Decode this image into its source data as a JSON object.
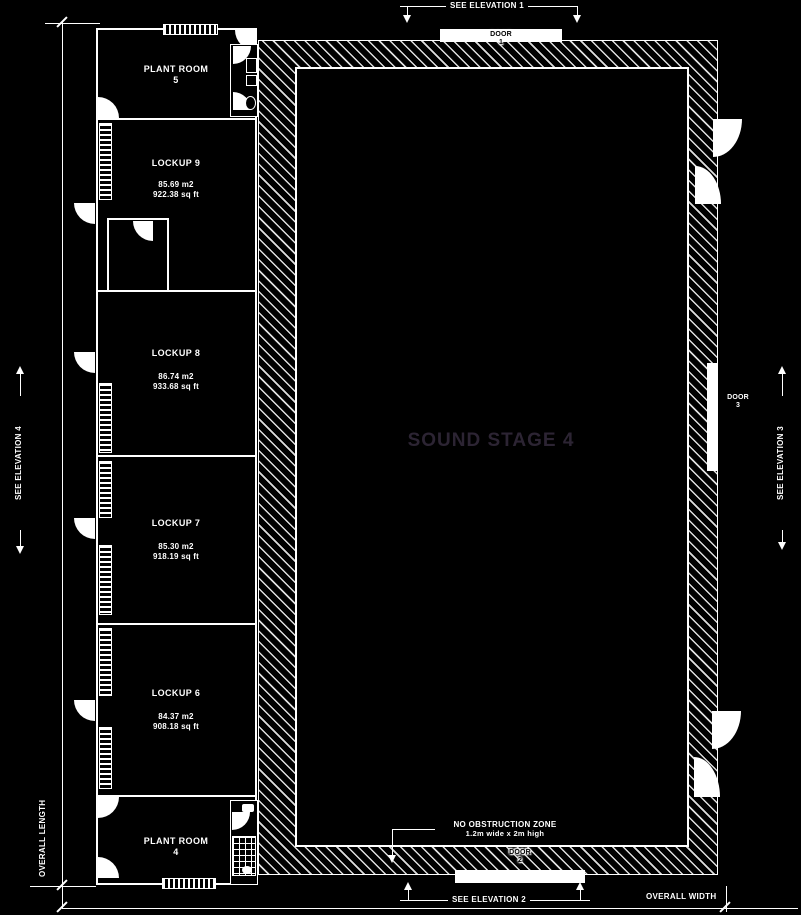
{
  "colors": {
    "background": "#000000",
    "line": "#ffffff",
    "stage_label": "#2c2433"
  },
  "stage": {
    "label": "SOUND STAGE 4"
  },
  "rooms": [
    {
      "id": "plant-room-5",
      "name": "PLANT ROOM",
      "number": "5"
    },
    {
      "id": "lockup-9",
      "name": "LOCKUP 9",
      "area_m2": "85.69 m2",
      "area_ft": "922.38 sq ft"
    },
    {
      "id": "lockup-8",
      "name": "LOCKUP 8",
      "area_m2": "86.74 m2",
      "area_ft": "933.68 sq ft"
    },
    {
      "id": "lockup-7",
      "name": "LOCKUP 7",
      "area_m2": "85.30 m2",
      "area_ft": "918.19 sq ft"
    },
    {
      "id": "lockup-6",
      "name": "LOCKUP 6",
      "area_m2": "84.37 m2",
      "area_ft": "908.18 sq ft"
    },
    {
      "id": "plant-room-4",
      "name": "PLANT ROOM",
      "number": "4"
    }
  ],
  "doors": [
    {
      "label": "DOOR",
      "number": "1"
    },
    {
      "label": "DOOR",
      "number": "2"
    },
    {
      "label": "DOOR",
      "number": "3"
    }
  ],
  "annotations": {
    "see_elevation_1": "SEE ELEVATION 1",
    "see_elevation_2": "SEE ELEVATION 2",
    "see_elevation_3": "SEE ELEVATION 3",
    "see_elevation_4": "SEE ELEVATION 4",
    "overall_length": "OVERALL LENGTH",
    "overall_width": "OVERALL WIDTH",
    "no_obstruction_line1": "NO OBSTRUCTION ZONE",
    "no_obstruction_line2": "1.2m wide x 2m high"
  }
}
